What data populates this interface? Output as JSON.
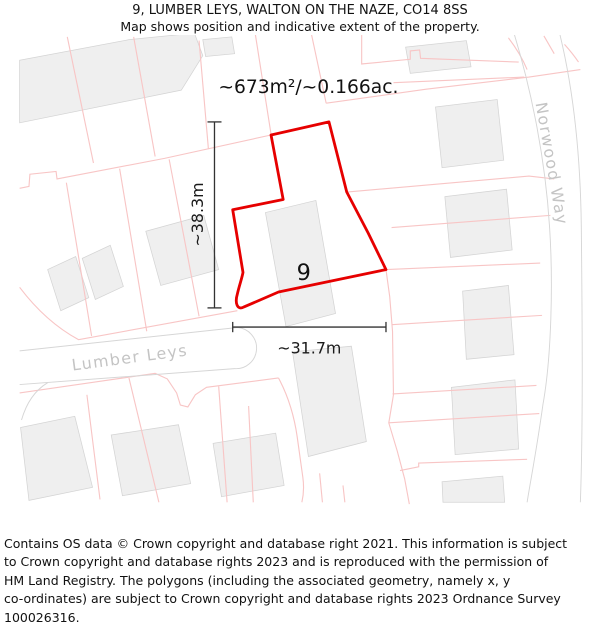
{
  "header": {
    "title": "9, LUMBER LEYS, WALTON ON THE NAZE, CO14 8SS",
    "subtitle": "Map shows position and indicative extent of the property."
  },
  "map": {
    "area_label": "~673m²/~0.166ac.",
    "height_label": "~38.3m",
    "width_label": "~31.7m",
    "plot_number": "9",
    "street_lumber": "Lumber Leys",
    "street_norwood": "Norwood Way",
    "colors": {
      "property_outline": "#e60000",
      "parcel_line": "#f8c5c5",
      "road_casing": "#d6d6d6",
      "building_fill": "#efefef",
      "building_stroke": "#d4d4d4",
      "street_label": "#c4c4c4",
      "dimension": "#333333"
    }
  },
  "footer": {
    "lines": [
      "Contains OS data © Crown copyright and database right 2021. This information is subject",
      "to Crown copyright and database rights 2023 and is reproduced with the permission of",
      "HM Land Registry. The polygons (including the associated geometry, namely x, y",
      "co-ordinates) are subject to Crown copyright and database rights 2023 Ordnance Survey",
      "100026316."
    ]
  }
}
